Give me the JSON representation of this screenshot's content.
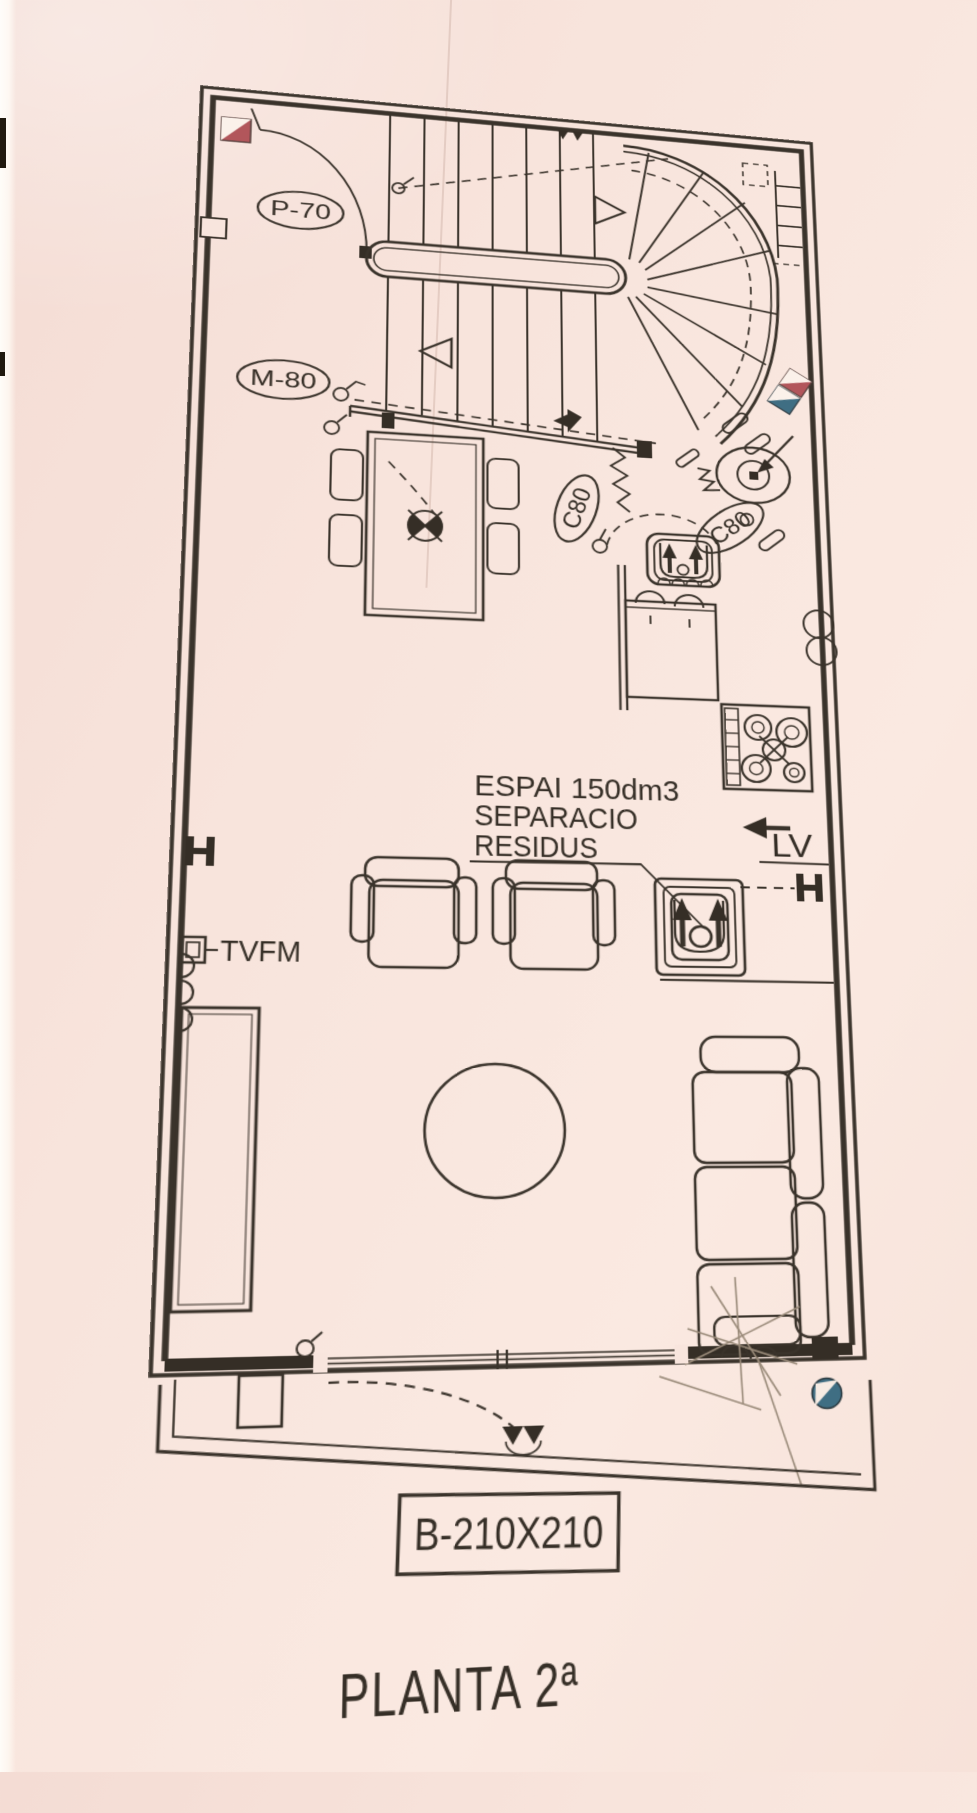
{
  "document": {
    "title": "PLANTA 2ª",
    "kind": "architectural floor plan (scanned)"
  },
  "labels": {
    "entry_door": "P-70",
    "hall_opening": "M-80",
    "duct_left": "C80",
    "duct_right": "C80",
    "dishwasher": "LV",
    "tv_fm_socket": "TVFM",
    "balcony_window": "B-210X210"
  },
  "annotations": {
    "waste_line1": "ESPAI  150dm3",
    "waste_line2": "SEPARACIO",
    "waste_line3": "RESIDUS"
  },
  "colors": {
    "paper": "#f8e5dd",
    "ink": "#3a332b",
    "pillar_red": "#b2565b",
    "pillar_blue": "#3f6e83",
    "pencil": "#998a79"
  }
}
